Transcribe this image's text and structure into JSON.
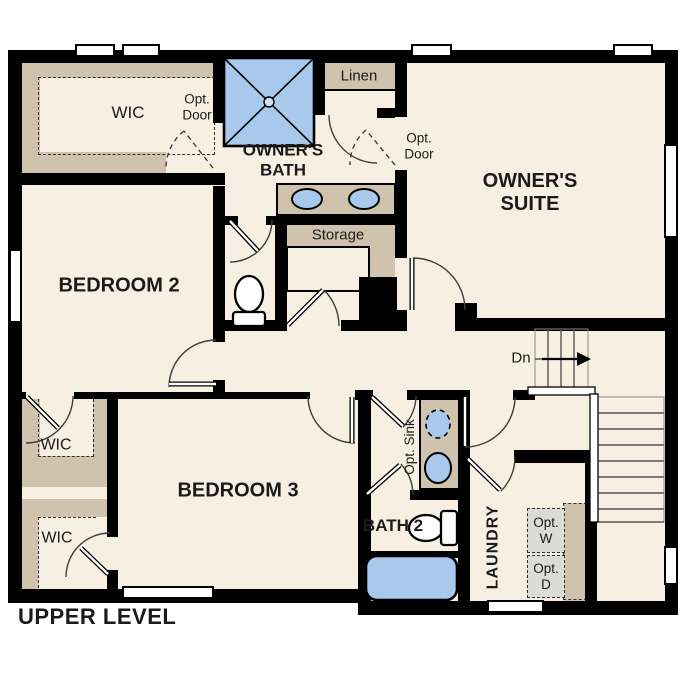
{
  "title": "UPPER LEVEL",
  "colors": {
    "floor": "#f7efe2",
    "wall": "#000000",
    "shelf": "#cfc3ad",
    "fixture_blue": "#a9c9ec",
    "appliance": "#dbdcd6",
    "ink": "#1b1b1b"
  },
  "labels": {
    "wic_top": "WIC",
    "wic_mid": "WIC",
    "wic_low": "WIC",
    "opt_door_upper": "Opt. Door",
    "opt_door_suite": "Opt. Door",
    "owners_bath": "OWNER'S BATH",
    "linen": "Linen",
    "owners_suite": "OWNER'S SUITE",
    "bedroom2": "BEDROOM 2",
    "storage": "Storage",
    "down": "Dn",
    "bedroom3": "BEDROOM 3",
    "opt_sink": "Opt. Sink",
    "bath2": "BATH 2",
    "laundry": "LAUNDRY",
    "opt_washer": "Opt. W",
    "opt_dryer": "Opt. D"
  }
}
